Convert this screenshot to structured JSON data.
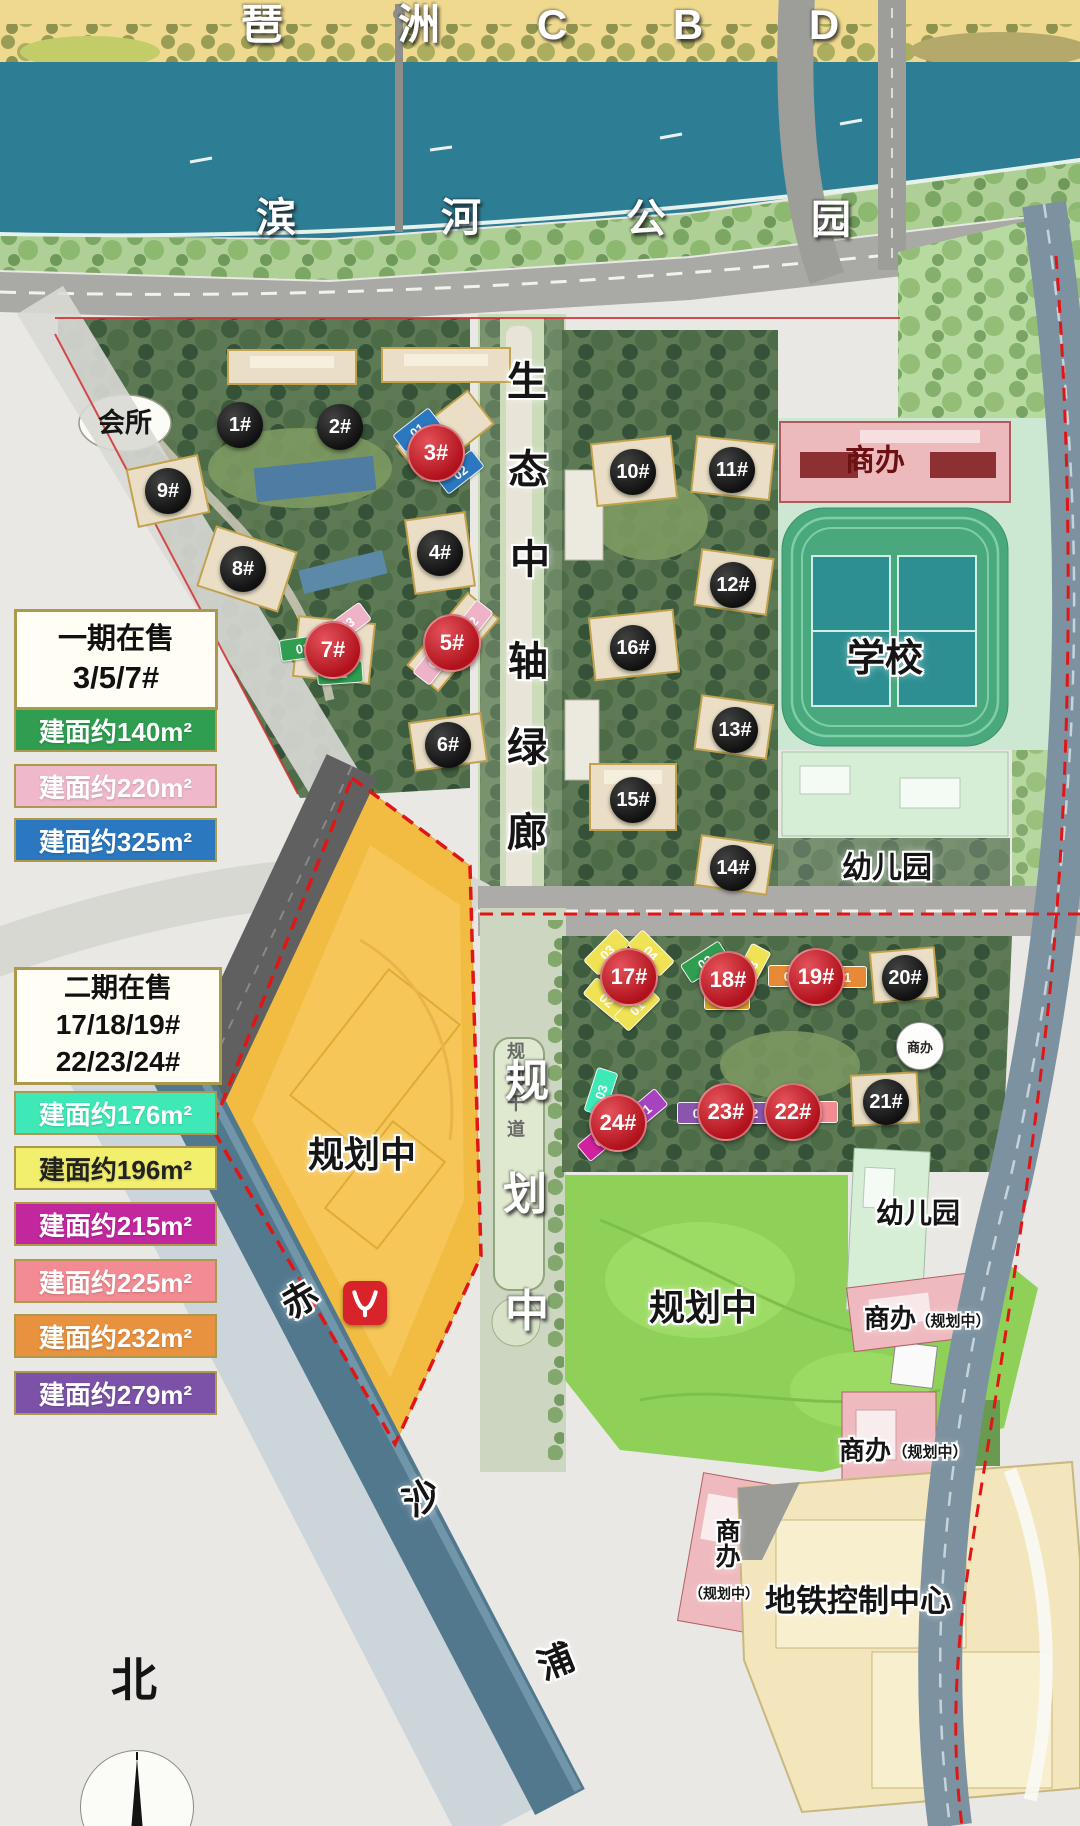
{
  "legend_phase1": {
    "title_lines": [
      "一期在售",
      "3/5/7#"
    ],
    "items": [
      {
        "label": "建面约140m²",
        "color": "#2f9e50",
        "text": "#ffffff",
        "y": 708
      },
      {
        "label": "建面约220m²",
        "color": "#f0b9cb",
        "text": "#ffffff",
        "y": 764
      },
      {
        "label": "建面约325m²",
        "color": "#2b78c0",
        "text": "#ffffff",
        "y": 818
      }
    ]
  },
  "legend_phase2": {
    "title_lines": [
      "二期在售",
      "17/18/19#",
      "22/23/24#"
    ],
    "items": [
      {
        "label": "建面约176m²",
        "color": "#3fe9b7",
        "text": "#ffffff",
        "y": 1091
      },
      {
        "label": "建面约196m²",
        "color": "#f2ef6d",
        "text": "#222222",
        "y": 1146
      },
      {
        "label": "建面约215m²",
        "color": "#c2279e",
        "text": "#ffffff",
        "y": 1202
      },
      {
        "label": "建面约225m²",
        "color": "#f28b92",
        "text": "#ffffff",
        "y": 1259
      },
      {
        "label": "建面约232m²",
        "color": "#e8923f",
        "text": "#ffffff",
        "y": 1314
      },
      {
        "label": "建面约279m²",
        "color": "#7b52a8",
        "text": "#ffffff",
        "y": 1371
      }
    ]
  },
  "buildings": [
    {
      "label": "1#",
      "badge": "black",
      "x": 240,
      "y": 425
    },
    {
      "label": "2#",
      "badge": "black",
      "x": 340,
      "y": 427
    },
    {
      "label": "9#",
      "badge": "black",
      "x": 168,
      "y": 491
    },
    {
      "label": "8#",
      "badge": "black",
      "x": 243,
      "y": 569
    },
    {
      "label": "4#",
      "badge": "black",
      "x": 440,
      "y": 553
    },
    {
      "label": "6#",
      "badge": "black",
      "x": 448,
      "y": 745
    },
    {
      "label": "10#",
      "badge": "black",
      "x": 633,
      "y": 472
    },
    {
      "label": "11#",
      "badge": "black",
      "x": 732,
      "y": 470
    },
    {
      "label": "12#",
      "badge": "black",
      "x": 733,
      "y": 585
    },
    {
      "label": "16#",
      "badge": "black",
      "x": 633,
      "y": 648
    },
    {
      "label": "13#",
      "badge": "black",
      "x": 735,
      "y": 730
    },
    {
      "label": "15#",
      "badge": "black",
      "x": 633,
      "y": 800
    },
    {
      "label": "14#",
      "badge": "black",
      "x": 733,
      "y": 868
    },
    {
      "label": "20#",
      "badge": "black",
      "x": 905,
      "y": 978
    },
    {
      "label": "21#",
      "badge": "black",
      "x": 886,
      "y": 1102
    },
    {
      "label": "3#",
      "badge": "red",
      "x": 436,
      "y": 453,
      "units": [
        {
          "label": "01",
          "x": 417,
          "y": 430,
          "rot": -38,
          "color": "#2b78c0"
        },
        {
          "label": "02",
          "x": 460,
          "y": 472,
          "rot": -38,
          "color": "#2b78c0"
        }
      ]
    },
    {
      "label": "5#",
      "badge": "red",
      "x": 452,
      "y": 643,
      "units": [
        {
          "label": "02",
          "x": 471,
          "y": 624,
          "rot": -52,
          "color": "#efb3c8"
        },
        {
          "label": "01",
          "x": 435,
          "y": 661,
          "rot": -52,
          "color": "#efb3c8"
        }
      ]
    },
    {
      "label": "7#",
      "badge": "red",
      "x": 333,
      "y": 650,
      "units": [
        {
          "label": "03",
          "x": 347,
          "y": 624,
          "rot": -36,
          "color": "#efb3c8"
        },
        {
          "label": "02",
          "x": 303,
          "y": 648,
          "rot": -8,
          "color": "#2f9e50"
        },
        {
          "label": "01",
          "x": 340,
          "y": 673,
          "rot": -4,
          "color": "#2f9e50"
        }
      ]
    },
    {
      "label": "17#",
      "badge": "red",
      "x": 629,
      "y": 977,
      "units": [
        {
          "label": "03",
          "x": 607,
          "y": 952,
          "rot": -45,
          "color": "#f0e255"
        },
        {
          "label": "04",
          "x": 651,
          "y": 953,
          "rot": 45,
          "color": "#f0e255"
        },
        {
          "label": "02",
          "x": 607,
          "y": 1000,
          "rot": 40,
          "color": "#f0e255"
        },
        {
          "label": "01",
          "x": 637,
          "y": 1008,
          "rot": -45,
          "color": "#f0e255"
        }
      ]
    },
    {
      "label": "18#",
      "badge": "red",
      "x": 728,
      "y": 980,
      "units": [
        {
          "label": "02",
          "x": 705,
          "y": 962,
          "rot": -33,
          "color": "#2f9e50"
        },
        {
          "label": "03",
          "x": 751,
          "y": 968,
          "rot": -62,
          "color": "#f0e255"
        },
        {
          "label": "01",
          "x": 727,
          "y": 999,
          "rot": 0,
          "color": "#dfa42e"
        }
      ]
    },
    {
      "label": "19#",
      "badge": "red",
      "x": 816,
      "y": 977,
      "units": [
        {
          "label": "02",
          "x": 791,
          "y": 976,
          "rot": 0,
          "color": "#e68a38"
        },
        {
          "label": "01",
          "x": 844,
          "y": 977,
          "rot": 0,
          "color": "#e68a38"
        }
      ]
    },
    {
      "label": "22#",
      "badge": "red",
      "x": 793,
      "y": 1112,
      "units": [
        {
          "label": "02",
          "x": 771,
          "y": 1113,
          "rot": 0,
          "color": "#f28b92"
        },
        {
          "label": "01",
          "x": 815,
          "y": 1112,
          "rot": 0,
          "color": "#f28b92"
        }
      ]
    },
    {
      "label": "23#",
      "badge": "red",
      "x": 726,
      "y": 1112,
      "units": [
        {
          "label": "01",
          "x": 700,
          "y": 1113,
          "rot": 0,
          "color": "#8a56ad"
        },
        {
          "label": "02",
          "x": 751,
          "y": 1113,
          "rot": 0,
          "color": "#8a56ad"
        }
      ]
    },
    {
      "label": "24#",
      "badge": "red",
      "x": 618,
      "y": 1123,
      "units": [
        {
          "label": "03",
          "x": 601,
          "y": 1092,
          "rot": -72,
          "color": "#3fe9b7"
        },
        {
          "label": "01",
          "x": 644,
          "y": 1111,
          "rot": -40,
          "color": "#a843c0"
        },
        {
          "label": "02",
          "x": 601,
          "y": 1139,
          "rot": -40,
          "color": "#d0219e"
        }
      ]
    },
    {
      "label": "商办",
      "badge": "white",
      "x": 920,
      "y": 1046
    }
  ],
  "map_labels": [
    {
      "name": "district-label-pa",
      "text": "琶",
      "x": 262,
      "y": 25,
      "size": 42,
      "color": "#ffffff",
      "halo": "dark"
    },
    {
      "name": "district-label-zhou",
      "text": "洲",
      "x": 419,
      "y": 25,
      "size": 42,
      "color": "#ffffff",
      "halo": "dark"
    },
    {
      "name": "district-label-c",
      "text": "C",
      "x": 552,
      "y": 25,
      "size": 42,
      "color": "#ffffff",
      "halo": "dark"
    },
    {
      "name": "district-label-b",
      "text": "B",
      "x": 688,
      "y": 25,
      "size": 42,
      "color": "#ffffff",
      "halo": "dark"
    },
    {
      "name": "district-label-d",
      "text": "D",
      "x": 824,
      "y": 25,
      "size": 42,
      "color": "#ffffff",
      "halo": "dark"
    },
    {
      "name": "park-label-bin",
      "text": "滨",
      "x": 276,
      "y": 218,
      "size": 40,
      "color": "#ffffff",
      "halo": "dark"
    },
    {
      "name": "park-label-he",
      "text": "河",
      "x": 461,
      "y": 218,
      "size": 40,
      "color": "#ffffff",
      "halo": "dark"
    },
    {
      "name": "park-label-gong",
      "text": "公",
      "x": 646,
      "y": 219,
      "size": 40,
      "color": "#ffffff",
      "halo": "dark"
    },
    {
      "name": "park-label-yuan",
      "text": "园",
      "x": 831,
      "y": 220,
      "size": 40,
      "color": "#ffffff",
      "halo": "dark"
    },
    {
      "name": "corridor-char-1",
      "text": "生",
      "x": 527,
      "y": 382,
      "size": 40,
      "color": "#151515",
      "halo": "white"
    },
    {
      "name": "corridor-char-2",
      "text": "态",
      "x": 528,
      "y": 470,
      "size": 40,
      "color": "#151515",
      "halo": "white"
    },
    {
      "name": "corridor-char-3",
      "text": "中",
      "x": 530,
      "y": 560,
      "size": 40,
      "color": "#151515",
      "halo": "white"
    },
    {
      "name": "corridor-char-4",
      "text": "轴",
      "x": 528,
      "y": 662,
      "size": 40,
      "color": "#151515",
      "halo": "white"
    },
    {
      "name": "corridor-char-5",
      "text": "绿",
      "x": 527,
      "y": 748,
      "size": 40,
      "color": "#151515",
      "halo": "white"
    },
    {
      "name": "corridor-char-6",
      "text": "廊",
      "x": 527,
      "y": 833,
      "size": 40,
      "color": "#151515",
      "halo": "white"
    },
    {
      "name": "trunk-road-small-1",
      "text": "规",
      "x": 516,
      "y": 1052,
      "size": 18,
      "color": "#6a6a6a"
    },
    {
      "name": "trunk-road-small-2",
      "text": "划",
      "x": 516,
      "y": 1078,
      "size": 18,
      "color": "#6a6a6a"
    },
    {
      "name": "trunk-road-small-3",
      "text": "干",
      "x": 516,
      "y": 1104,
      "size": 18,
      "color": "#6a6a6a"
    },
    {
      "name": "trunk-road-small-4",
      "text": "道",
      "x": 516,
      "y": 1130,
      "size": 18,
      "color": "#6a6a6a"
    },
    {
      "name": "road-char-1",
      "text": "规",
      "x": 527,
      "y": 1082,
      "size": 44,
      "color": "#ffffff",
      "halo": "dark"
    },
    {
      "name": "road-char-2",
      "text": "划",
      "x": 525,
      "y": 1195,
      "size": 44,
      "color": "#ffffff",
      "halo": "dark"
    },
    {
      "name": "road-char-3",
      "text": "中",
      "x": 527,
      "y": 1312,
      "size": 44,
      "color": "#ffffff",
      "halo": "dark"
    },
    {
      "name": "creek-char-chi",
      "text": "赤",
      "x": 300,
      "y": 1300,
      "size": 36,
      "color": "#151515",
      "halo": "white",
      "rot": -30
    },
    {
      "name": "creek-char-sha",
      "text": "沙",
      "x": 422,
      "y": 1498,
      "size": 36,
      "color": "#151515",
      "halo": "white",
      "rot": -30
    },
    {
      "name": "creek-char-pu",
      "text": "浦",
      "x": 556,
      "y": 1662,
      "size": 36,
      "color": "#151515",
      "halo": "white",
      "rot": -22
    },
    {
      "name": "clubhouse-label",
      "text": "会所",
      "x": 125,
      "y": 423,
      "size": 27,
      "color": "#151515"
    },
    {
      "name": "shangban-label-north",
      "text": "商办",
      "x": 875,
      "y": 461,
      "size": 30,
      "color": "#6b1114"
    },
    {
      "name": "school-label",
      "text": "学校",
      "x": 885,
      "y": 660,
      "size": 38,
      "color": "#151515",
      "halo": "white"
    },
    {
      "name": "kindergarten-label-1",
      "text": "幼儿园",
      "x": 887,
      "y": 868,
      "size": 30,
      "color": "#151515",
      "halo": "white"
    },
    {
      "name": "kindergarten-label-2",
      "text": "幼儿园",
      "x": 918,
      "y": 1213,
      "size": 28,
      "color": "#151515",
      "halo": "white"
    },
    {
      "name": "planning-label-west",
      "text": "规划中",
      "x": 362,
      "y": 1155,
      "size": 36,
      "color": "#151515",
      "halo": "white"
    },
    {
      "name": "planning-label-south",
      "text": "规划中",
      "x": 703,
      "y": 1308,
      "size": 36,
      "color": "#151515",
      "halo": "white"
    },
    {
      "name": "shangban-label-ne",
      "text": "商办",
      "x": 890,
      "y": 1319,
      "size": 26,
      "color": "#151515",
      "halo": "white"
    },
    {
      "name": "shangban-label-ne-sub",
      "text": "（规划中）",
      "x": 953,
      "y": 1322,
      "size": 15,
      "color": "#151515",
      "halo": "white"
    },
    {
      "name": "shangban-label-mid",
      "text": "商办",
      "x": 865,
      "y": 1451,
      "size": 26,
      "color": "#151515",
      "halo": "white"
    },
    {
      "name": "shangban-label-mid-sub",
      "text": "（规划中）",
      "x": 930,
      "y": 1453,
      "size": 15,
      "color": "#151515",
      "halo": "white"
    },
    {
      "name": "shangban-label-sw",
      "text": "商办",
      "x": 726,
      "y": 1543,
      "size": 25,
      "color": "#151515",
      "halo": "white",
      "vertical": true
    },
    {
      "name": "shangban-label-sw-sub",
      "text": "（规划中）",
      "x": 724,
      "y": 1594,
      "size": 14,
      "color": "#151515",
      "halo": "white"
    },
    {
      "name": "metro-center-label",
      "text": "地铁控制中心",
      "x": 858,
      "y": 1602,
      "size": 31,
      "color": "#151515",
      "halo": "white"
    }
  ],
  "compass": {
    "label": "北"
  },
  "metro_logo": {
    "color": "#d8232a",
    "icon": "guangzhou-metro-goat-horn"
  }
}
